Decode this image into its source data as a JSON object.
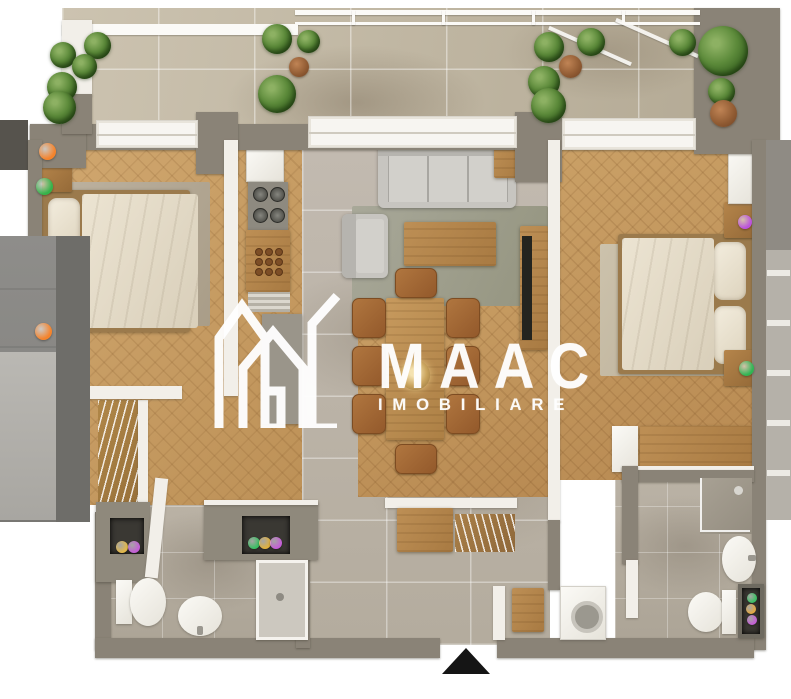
{
  "logo": {
    "brand": "MAAC",
    "tagline": "IMOBILIARE"
  },
  "colors": {
    "wall": "#8a8377",
    "wall_white": "#f2efe9",
    "wood_floor_left": "#c79d66",
    "wood_floor_right": "#c0935a",
    "tile_floor": "#bdb5a7",
    "balcony_tile": "#c8bfac",
    "logo_white": "#ffffff",
    "entrance_arrow": "#151515",
    "accent_orange": "#f5832b",
    "accent_green": "#35b34a",
    "accent_purple": "#c45fd6",
    "accent_yellow": "#e5b93c"
  },
  "markers": [
    {
      "name": "hotspot-bedroom1-orange-top",
      "color": "#f5832b",
      "x": 47,
      "y": 151,
      "d": 17
    },
    {
      "name": "hotspot-bedroom1-green",
      "color": "#35b34a",
      "x": 44,
      "y": 186,
      "d": 17
    },
    {
      "name": "hotspot-bedroom1-orange-bottom",
      "color": "#f5832b",
      "x": 43,
      "y": 331,
      "d": 17
    },
    {
      "name": "hotspot-bedroom2-purple",
      "color": "#bb52dd",
      "x": 745,
      "y": 222,
      "d": 14
    },
    {
      "name": "hotspot-bedroom2-green",
      "color": "#2fb553",
      "x": 746,
      "y": 368,
      "d": 15
    },
    {
      "name": "hotspot-bath1-niche-yellow",
      "color": "#e3b84a",
      "x": 122,
      "y": 547,
      "d": 12
    },
    {
      "name": "hotspot-bath1-niche-purple",
      "color": "#c45fd6",
      "x": 134,
      "y": 547,
      "d": 12
    },
    {
      "name": "hotspot-hall-niche-green",
      "color": "#3bbf63",
      "x": 254,
      "y": 543,
      "d": 12
    },
    {
      "name": "hotspot-hall-niche-yellow",
      "color": "#e0b13e",
      "x": 265,
      "y": 543,
      "d": 12
    },
    {
      "name": "hotspot-hall-niche-purple",
      "color": "#c45fd6",
      "x": 276,
      "y": 543,
      "d": 12
    },
    {
      "name": "hotspot-bath2-niche-green",
      "color": "#3bbf63",
      "x": 752,
      "y": 598,
      "d": 10
    },
    {
      "name": "hotspot-bath2-niche-orange",
      "color": "#e2a844",
      "x": 751,
      "y": 609,
      "d": 10
    },
    {
      "name": "hotspot-bath2-niche-purple",
      "color": "#c45fd6",
      "x": 752,
      "y": 620,
      "d": 10
    }
  ]
}
